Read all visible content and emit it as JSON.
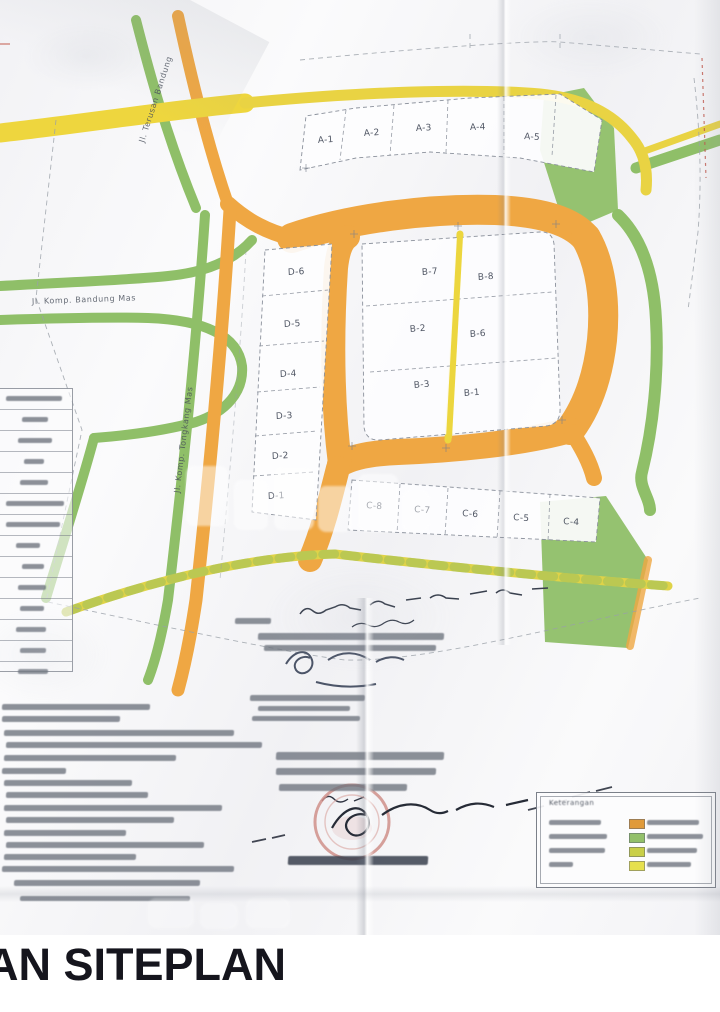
{
  "caption": "AN SITEPLAN",
  "siteplan": {
    "streets": {
      "horizontal": "Jl. Komp. Bandung Mas",
      "diagonal": "Jl. Komp. Tongkang Mas",
      "top_diagonal": "Jl. Terusan Bandung"
    },
    "plots_a": [
      "A-1",
      "A-2",
      "A-3",
      "A-4",
      "A-5"
    ],
    "plots_b": [
      "B-7",
      "B-8",
      "B-2",
      "B-6",
      "B-3",
      "B-1"
    ],
    "plots_c": [
      "C-8",
      "C-7",
      "C-6",
      "C-5",
      "C-4"
    ],
    "plots_d": [
      "D-6",
      "D-5",
      "D-4",
      "D-3",
      "D-2",
      "D-1"
    ],
    "colors": {
      "road_orange": "#efa743",
      "road_yellow": "#ecd43c",
      "greenway": "#8fbf68",
      "stamp_red": "#cf8f8a",
      "pencil": "#8b919c"
    },
    "legend": {
      "title": "Keterangan",
      "legible": false,
      "swatches": [
        "#e09a3a",
        "#93c06a",
        "#c9cf48",
        "#e6e04e"
      ]
    },
    "left_table": {
      "row_count": 13,
      "legible": false
    },
    "notes": {
      "line_count": 16,
      "legible": false
    },
    "stamp_block": {
      "legible": false,
      "has_red_stamp": true,
      "has_signatures": true
    },
    "watermark": {
      "present": true,
      "legible": false
    }
  }
}
